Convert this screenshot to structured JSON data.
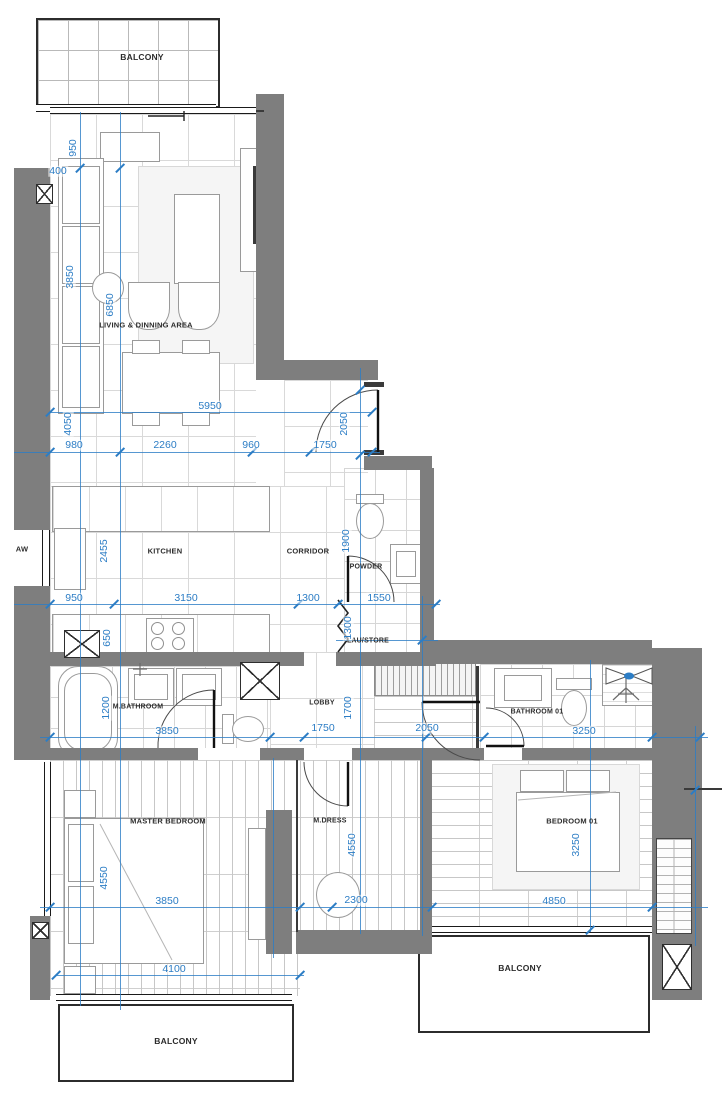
{
  "drawing": {
    "kind": "apartment floor plan",
    "units": "mm"
  },
  "colors": {
    "wall_fill": "#7e7e7e",
    "dimension_blue": "#2c7dc5",
    "line_dark": "#2c2c2c",
    "floor_line": "#d6d6d6"
  },
  "rooms": [
    {
      "id": "balcony-top",
      "label": "BALCONY"
    },
    {
      "id": "living",
      "label": "LIVING & DINNING AREA"
    },
    {
      "id": "kitchen",
      "label": "KITCHEN"
    },
    {
      "id": "corridor",
      "label": "CORRIDOR"
    },
    {
      "id": "powder",
      "label": "POWDER"
    },
    {
      "id": "laustore",
      "label": "LAU/STORE"
    },
    {
      "id": "mbathroom",
      "label": "M.BATHROOM"
    },
    {
      "id": "lobby",
      "label": "LOBBY"
    },
    {
      "id": "bathroom01",
      "label": "BATHROOM 01"
    },
    {
      "id": "master",
      "label": "MASTER BEDROOM"
    },
    {
      "id": "mdress",
      "label": "M.DRESS"
    },
    {
      "id": "bedroom01",
      "label": "BEDROOM 01"
    },
    {
      "id": "aw",
      "label": "AW"
    },
    {
      "id": "balcony-right",
      "label": "BALCONY"
    },
    {
      "id": "balcony-left",
      "label": "BALCONY"
    }
  ],
  "dimensions_mm": [
    {
      "id": "d400",
      "value": "400"
    },
    {
      "id": "d950t",
      "value": "950"
    },
    {
      "id": "d3850l",
      "value": "3850"
    },
    {
      "id": "d6850",
      "value": "6850"
    },
    {
      "id": "d4050",
      "value": "4050"
    },
    {
      "id": "d5950",
      "value": "5950"
    },
    {
      "id": "d980",
      "value": "980"
    },
    {
      "id": "d2260",
      "value": "2260"
    },
    {
      "id": "d960",
      "value": "960"
    },
    {
      "id": "d1750e",
      "value": "1750"
    },
    {
      "id": "d2050e",
      "value": "2050"
    },
    {
      "id": "d2455",
      "value": "2455"
    },
    {
      "id": "d1900",
      "value": "1900"
    },
    {
      "id": "d950k",
      "value": "950"
    },
    {
      "id": "d3150",
      "value": "3150"
    },
    {
      "id": "d1300c",
      "value": "1300"
    },
    {
      "id": "d1550",
      "value": "1550"
    },
    {
      "id": "d1300v",
      "value": "1300"
    },
    {
      "id": "d650",
      "value": "650"
    },
    {
      "id": "d1200",
      "value": "1200"
    },
    {
      "id": "d1700",
      "value": "1700"
    },
    {
      "id": "d3850b",
      "value": "3850"
    },
    {
      "id": "d1750l",
      "value": "1750"
    },
    {
      "id": "d2050w",
      "value": "2050"
    },
    {
      "id": "d3250b",
      "value": "3250"
    },
    {
      "id": "d4550m",
      "value": "4550"
    },
    {
      "id": "d4550d",
      "value": "4550"
    },
    {
      "id": "d3250v",
      "value": "3250"
    },
    {
      "id": "d3850m",
      "value": "3850"
    },
    {
      "id": "d2300",
      "value": "2300"
    },
    {
      "id": "d4850",
      "value": "4850"
    },
    {
      "id": "d4100",
      "value": "4100"
    }
  ]
}
